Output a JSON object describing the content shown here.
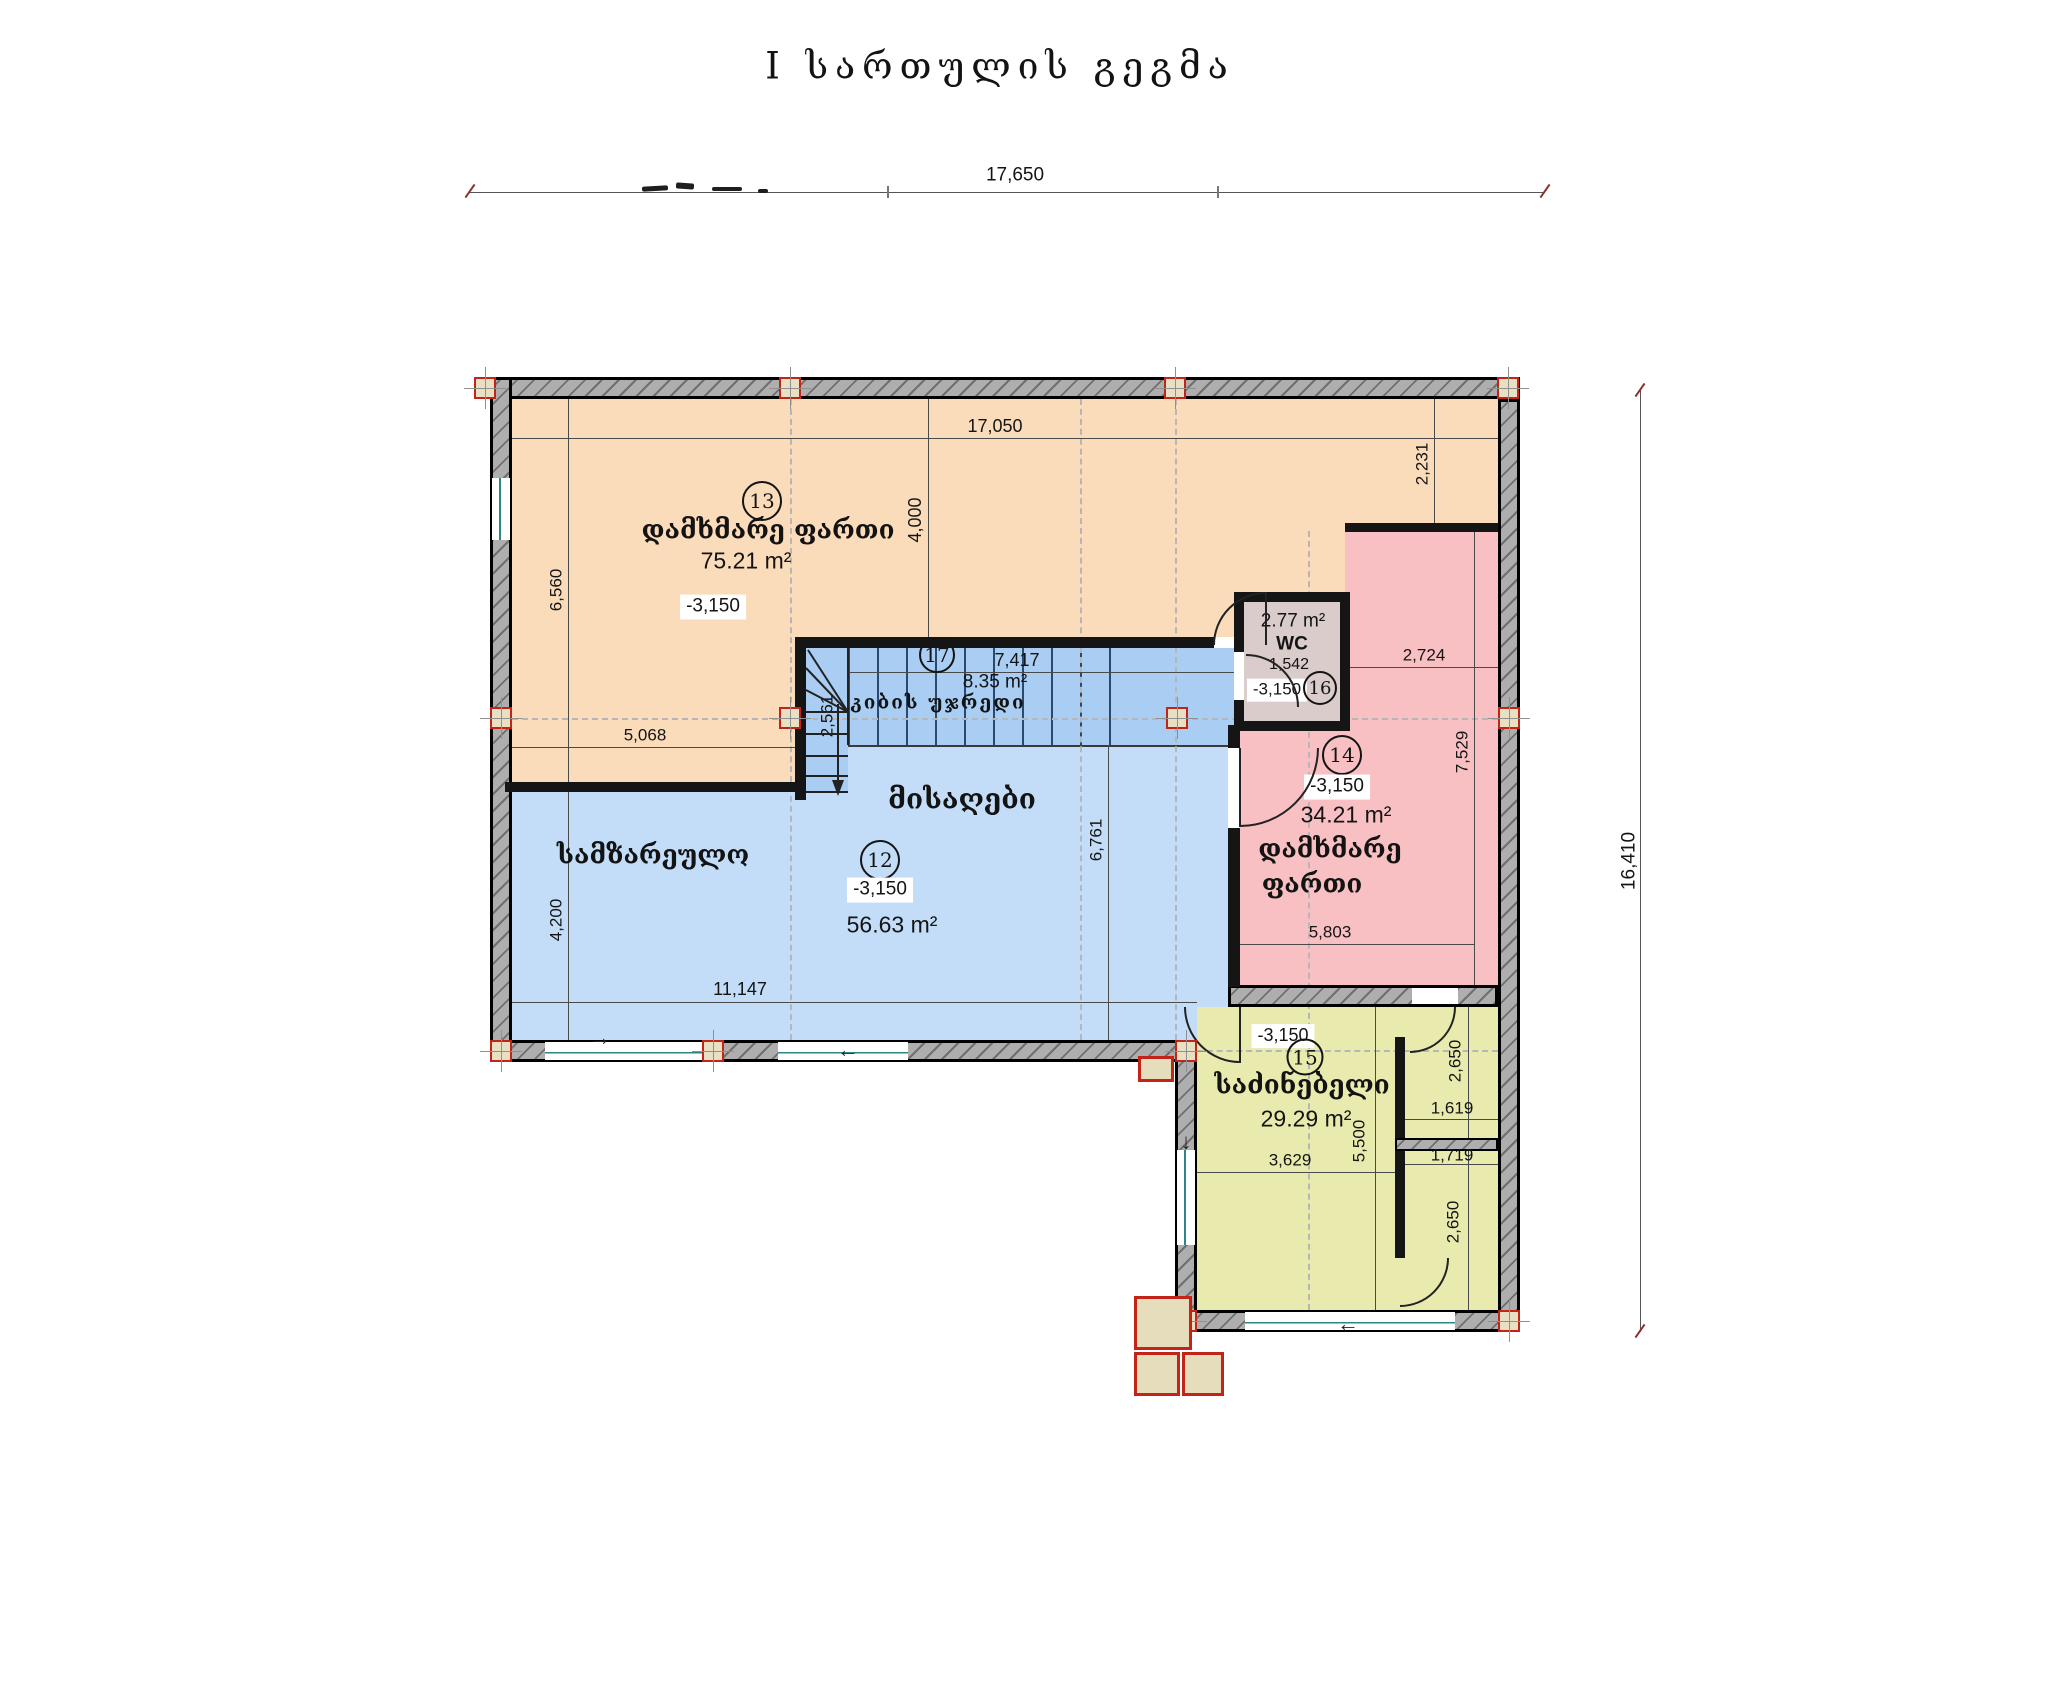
{
  "title": "I სართულის გეგმა",
  "dims": {
    "top_total": "17,650",
    "right_total": "16,410",
    "interior_top": "17,050",
    "v4000": "4,000",
    "v6560": "6,560",
    "v2231": "2,231",
    "h5068": "5,068",
    "v2561": "2,561",
    "h7417": "7,417",
    "h2724": "2,724",
    "v7529": "7,529",
    "v6761": "6,761",
    "h5803": "5,803",
    "v4200": "4,200",
    "h11147": "11,147",
    "v5500": "5,500",
    "h3629": "3,629",
    "h1619": "1,619",
    "h1719": "1,719",
    "v2650a": "2,650",
    "v2650b": "2,650"
  },
  "rooms": {
    "aux_top": {
      "num": "13",
      "name": "დამხმარე  ფართი",
      "area": "75.21 m²",
      "level": "-3,150"
    },
    "living": {
      "num": "12",
      "name": "მისაღები",
      "kitchen": "სამზარეულო",
      "area": "56.63 m²",
      "level": "-3,150"
    },
    "stairs": {
      "num": "17",
      "name": "კიბის  უჯრედი",
      "area": "8.35 m²"
    },
    "wc": {
      "num": "16",
      "name": "WC",
      "area": "2.77 m²",
      "level": "-3,150",
      "width": "1,542"
    },
    "aux_right": {
      "num": "14",
      "name_l1": "დამხმარე",
      "name_l2": "ფართი",
      "area": "34.21 m²",
      "level": "-3,150"
    },
    "bedroom": {
      "num": "15",
      "name": "საძინებელი",
      "area": "29.29 m²",
      "level": "-3,150"
    }
  },
  "glyphs": {
    "arrow_right": "→",
    "arrow_left": "←",
    "arrow_down": "↓"
  },
  "colors": {
    "aux_top": "#fbdcba",
    "living": "#c3ddf8",
    "stair": "#a9cdf3",
    "aux_right": "#f9c0c4",
    "bedroom": "#e9ebae",
    "wc": "#d9cccb",
    "wall": "#aeaeae",
    "column_marker": "#c22418",
    "window_sill": "#2e8585"
  }
}
